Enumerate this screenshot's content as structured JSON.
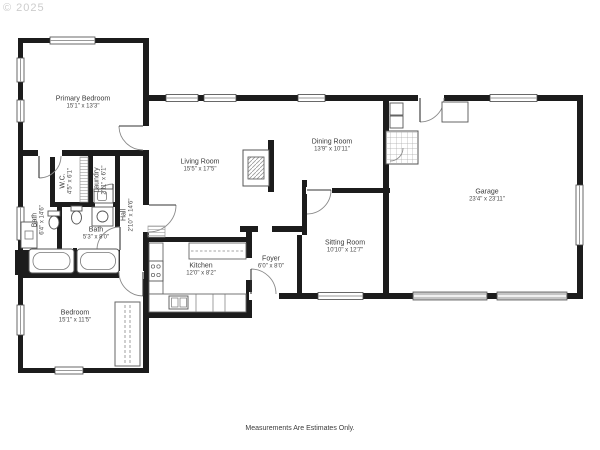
{
  "watermark": "© 2025",
  "footer": "Measurements Are Estimates Only.",
  "rooms": [
    {
      "name": "Primary Bedroom",
      "dims": "15'1\" x 13'3\""
    },
    {
      "name": "Living Room",
      "dims": "15'5\" x 17'5\""
    },
    {
      "name": "Dining Room",
      "dims": "13'9\" x 10'11\""
    },
    {
      "name": "Garage",
      "dims": "23'4\" x 23'11\""
    },
    {
      "name": "Sitting Room",
      "dims": "10'10\" x 12'7\""
    },
    {
      "name": "Kitchen",
      "dims": "12'0\" x 8'2\""
    },
    {
      "name": "Foyer",
      "dims": "6'0\" x 8'0\""
    },
    {
      "name": "Bedroom",
      "dims": "15'1\" x 11'5\""
    },
    {
      "name": "Bath",
      "dims": "5'3\" x 8'0\""
    },
    {
      "name": "Bath",
      "dims": "6'4\" x 14'6\""
    },
    {
      "name": "W.C.",
      "dims": "4'5\" x 6'1\""
    },
    {
      "name": "Laundry",
      "dims": "2'11\" x 6'1\""
    },
    {
      "name": "Hall",
      "dims": "2'10\" x 14'6\""
    }
  ],
  "colors": {
    "wall": "#1c1c1c",
    "window_line": "#999999",
    "garage_door": "#c4c4c4",
    "watermark": "#cccccc"
  }
}
